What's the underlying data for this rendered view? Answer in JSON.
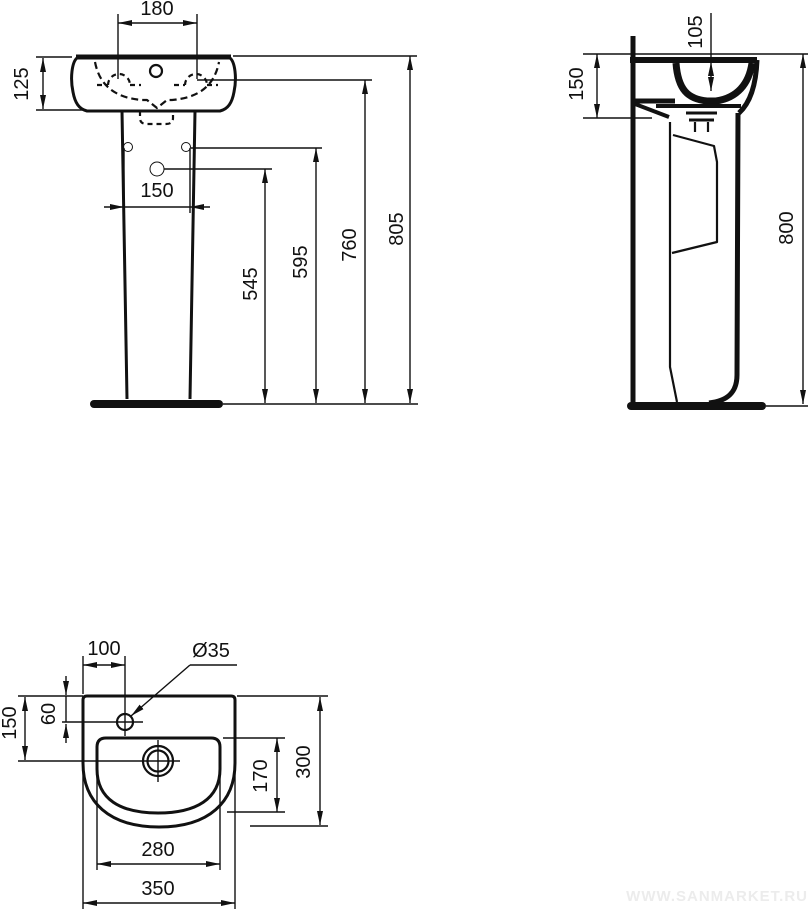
{
  "watermark": "WWW.SANMARKET.RU",
  "colors": {
    "line": "#111111",
    "background": "#ffffff",
    "watermark": "#ececec"
  },
  "front": {
    "tap_centers": "180",
    "basin_height": "125",
    "fixing_hole_spacing": "150",
    "siphon_outlet_height": "545",
    "fixing_hole_height": "595",
    "tap_ledge_height": "760",
    "overall_height": "805"
  },
  "side": {
    "bowl_depth": "105",
    "apron_height": "150",
    "overall_height": "800"
  },
  "top": {
    "tap_hole_offset_left": "100",
    "tap_hole_diameter": "Ø35",
    "tap_hole_offset_back": "60",
    "drain_offset_back": "150",
    "bowl_inner_depth": "170",
    "overall_depth": "300",
    "bowl_inner_width": "280",
    "overall_width": "350"
  }
}
